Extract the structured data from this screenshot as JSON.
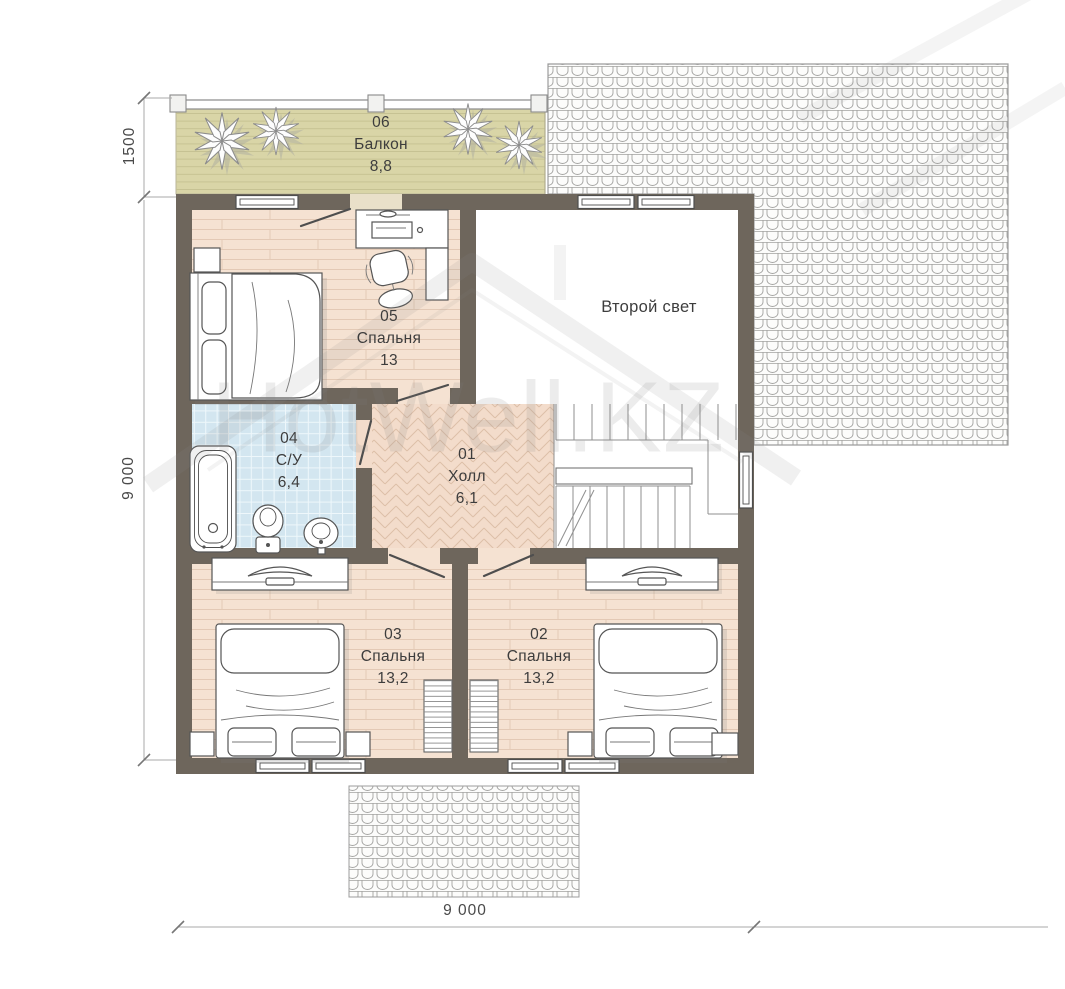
{
  "plan": {
    "rooms": {
      "balcony": {
        "id": "06",
        "name": "Балкон",
        "area": "8,8"
      },
      "bedroom_05": {
        "id": "05",
        "name": "Спальня",
        "area": "13"
      },
      "second_light": {
        "name": "Второй свет"
      },
      "bathroom": {
        "id": "04",
        "name": "С/У",
        "area": "6,4"
      },
      "hall": {
        "id": "01",
        "name": "Холл",
        "area": "6,1"
      },
      "bedroom_03": {
        "id": "03",
        "name": "Спальня",
        "area": "13,2"
      },
      "bedroom_02": {
        "id": "02",
        "name": "Спальня",
        "area": "13,2"
      }
    },
    "dimensions": {
      "balcony_depth": "1500",
      "side": "9 000",
      "width": "9 000"
    },
    "watermark": "HotWell.KZ",
    "colors": {
      "wall": "#6e665c",
      "bedroom_floor": "#f5e2d2",
      "balcony_floor": "#d9d5a7",
      "bathroom_floor": "#d3e6f0",
      "hall_floor": "#f3dccb",
      "roof_hatch_line": "#a3a3a1"
    }
  }
}
